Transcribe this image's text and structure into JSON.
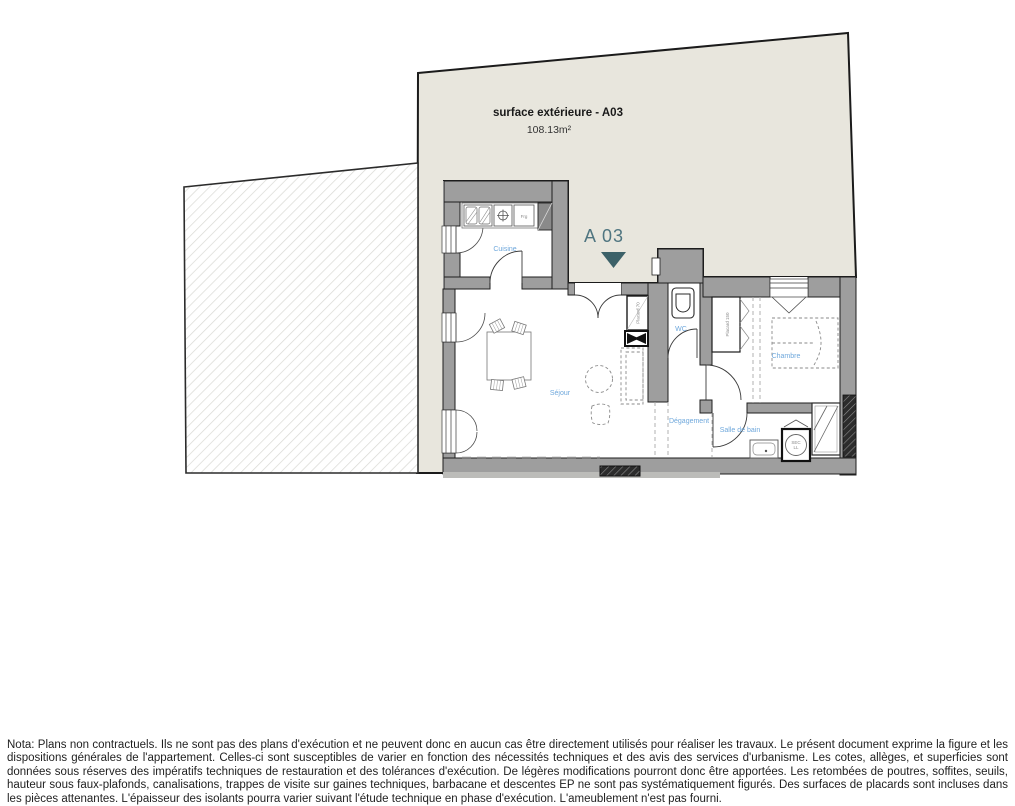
{
  "exterior": {
    "title": "surface extérieure - A03",
    "area": "108.13m²"
  },
  "unit": {
    "label": "A 03"
  },
  "rooms": {
    "cuisine": "Cuisine",
    "sejour": "Séjour",
    "wc": "WC",
    "degagement": "Dégagement",
    "chambre": "Chambre",
    "salle_de_bain": "Salle de bain"
  },
  "fixtures": {
    "fridge": "Frg",
    "entry_closet": "Placard 70",
    "bedroom_closet": "Placard 150",
    "washer_top": "SEC",
    "washer_bottom": "LL"
  },
  "colors": {
    "exterior_surface": "#e8e6dd",
    "wall_gray": "#9e9e9e",
    "room_label_blue": "#6fa8dc",
    "unit_label": "#4f7580",
    "marker_teal": "#3c6168"
  },
  "footer": {
    "nota": "Nota: Plans non contractuels. Ils ne sont pas des plans d'exécution et ne peuvent donc en aucun cas être directement utilisés pour réaliser les travaux. Le présent document exprime la figure et les dispositions générales de l'appartement. Celles-ci sont susceptibles de varier en fonction des nécessités techniques et des avis des services d'urbanisme. Les cotes, allèges, et superficies sont données sous réserves des impératifs techniques de restauration et des tolérances d'exécution. De légères modifications pourront donc être apportées. Les retombées de poutres, soffites, seuils,  hauteur sous faux-plafonds, canalisations, trappes de visite sur gaines techniques, barbacane et descentes EP ne sont pas systématiquement figurés. Des surfaces de placards sont incluses dans les pièces attenantes. L'épaisseur des isolants pourra varier suivant l'étude technique en phase d'exécution. L'ameublement n'est pas fourni."
  }
}
